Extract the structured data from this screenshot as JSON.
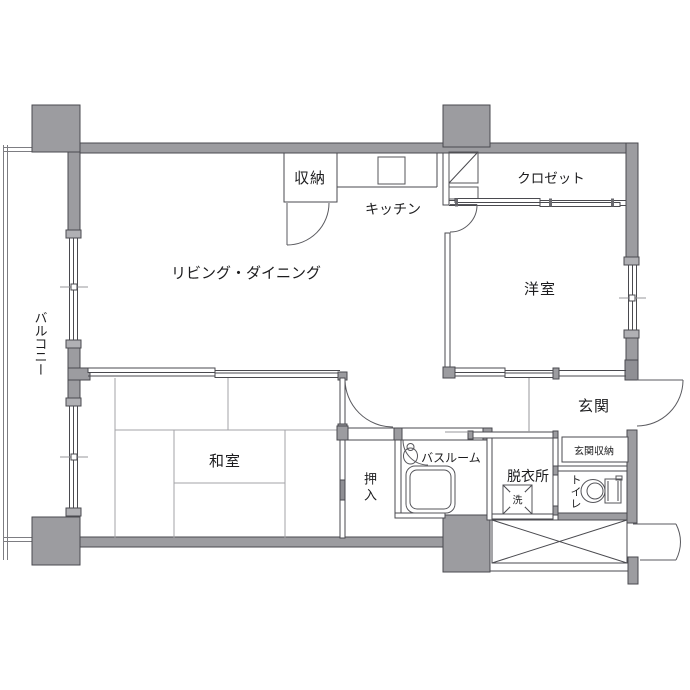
{
  "colors": {
    "wall": "#9c9ca0",
    "line": "#4a4a4f",
    "line_light": "#97979b",
    "text": "#1c1c1e",
    "bg": "#ffffff"
  },
  "rooms": {
    "living": {
      "label": "リビング・ダイニング"
    },
    "storage": {
      "label": "収納"
    },
    "kitchen": {
      "label": "キッチン"
    },
    "closet": {
      "label": "クロゼット"
    },
    "western": {
      "label": "洋室"
    },
    "japanese": {
      "label": "和室"
    },
    "oshiire": {
      "label": "押入"
    },
    "bathroom": {
      "label": "バスルーム"
    },
    "dressing": {
      "label": "脱衣所"
    },
    "toilet": {
      "label": "トイレ"
    },
    "entrance": {
      "label": "玄関"
    },
    "entrance_storage": {
      "label": "玄関収納"
    },
    "balcony": {
      "label": "バルコニー"
    },
    "washer": {
      "label": "洗"
    }
  }
}
